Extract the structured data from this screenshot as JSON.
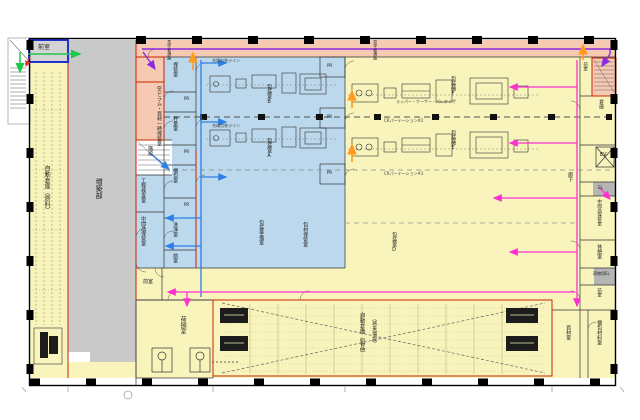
{
  "drawing": {
    "type": "factory-floor-plan",
    "colors": {
      "wall": "#111111",
      "zone_yellow": "#f8f4bb",
      "zone_blue": "#bcd8ec",
      "zone_pink": "#f6c9b2",
      "zone_gray": "#c9c9c9",
      "fire_border_red": "#cc2200",
      "room_border_blue": "#2233cc",
      "flow_green": "#1ec84b",
      "flow_orange": "#ff9a1e",
      "flow_blue": "#2e7fe8",
      "flow_magenta": "#ff2fd2",
      "flow_purple": "#8a2be2"
    }
  },
  "rooms": {
    "anteroom": "前室",
    "raw_warehouse": "自動倉庫（原料）",
    "annex": "増築部",
    "visitor_corridor": "見学者通路",
    "empty_drum": "空ドラム・資材一時保管室",
    "stairs": "階段",
    "process_inspection": "工程検査室",
    "intermediate_storage": "中間品保管室",
    "storage": "保管室",
    "pass_room": "PR",
    "weighing": "秤量室",
    "packing": "梱包室",
    "washing": "洗浄室",
    "packaging_b": "包装室B",
    "packaging_a": "包装室A",
    "packaging_prep": "包装準備室",
    "material_storage": "包材保管室",
    "filler_f": "包装機F",
    "filler_e": "包装機E",
    "packaging_d": "包装室D",
    "corridor": "廊下",
    "stair_room": "階段室",
    "warehouse_r": "倉庫",
    "elevator": "EV",
    "el": "EL",
    "lounge": "休憩室",
    "freight_el": "荷物用EL",
    "materials_room": "資材室",
    "packing_materials": "梱包材料室",
    "product_warehouse": "自動倉庫（製品）",
    "future_expansion": "（将来増設）",
    "shipping_room": "荷捌室"
  },
  "annotations": {
    "cr2": "CRパーテーション#2",
    "cr3": "CRパーテーション#3",
    "palletizer": "ラッパー・ケーサー・パレタイザ",
    "line_caption": "充填包装ライン"
  }
}
